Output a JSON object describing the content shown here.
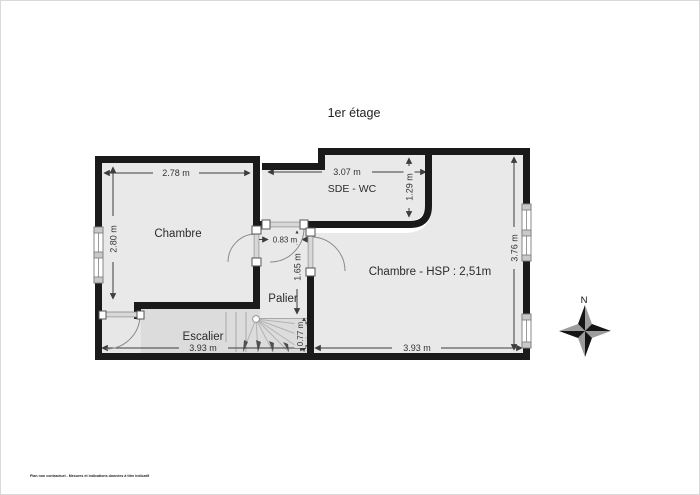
{
  "title": "1er étage",
  "rooms": {
    "chambre": {
      "label": "Chambre"
    },
    "sde_wc": {
      "label": "SDE - WC"
    },
    "palier": {
      "label": "Palier"
    },
    "escalier": {
      "label": "Escalier"
    },
    "chambre2": {
      "label": "Chambre - HSP : 2,51m"
    }
  },
  "dimensions": {
    "chambre_width": "2.78 m",
    "chambre_height": "2.80 m",
    "sde_width": "3.07 m",
    "sde_height": "1.29 m",
    "palier_door_width": "0.83 m",
    "palier_height": "1.65 m",
    "chambre2_height": "3.76 m",
    "stair_width": "0.77 m",
    "escalier_width": "3.93 m",
    "chambre2_width": "3.93 m"
  },
  "compass": {
    "north": "N"
  },
  "footer": {
    "disclaimer": "Plan non contractuel - Mesures et indications données à titre indicatif"
  },
  "colors": {
    "wall": "#1a1a1a",
    "room_fill": "#e9e9e9",
    "stair_fill": "#dcdcdc",
    "dimension": "#3d3d3d"
  }
}
